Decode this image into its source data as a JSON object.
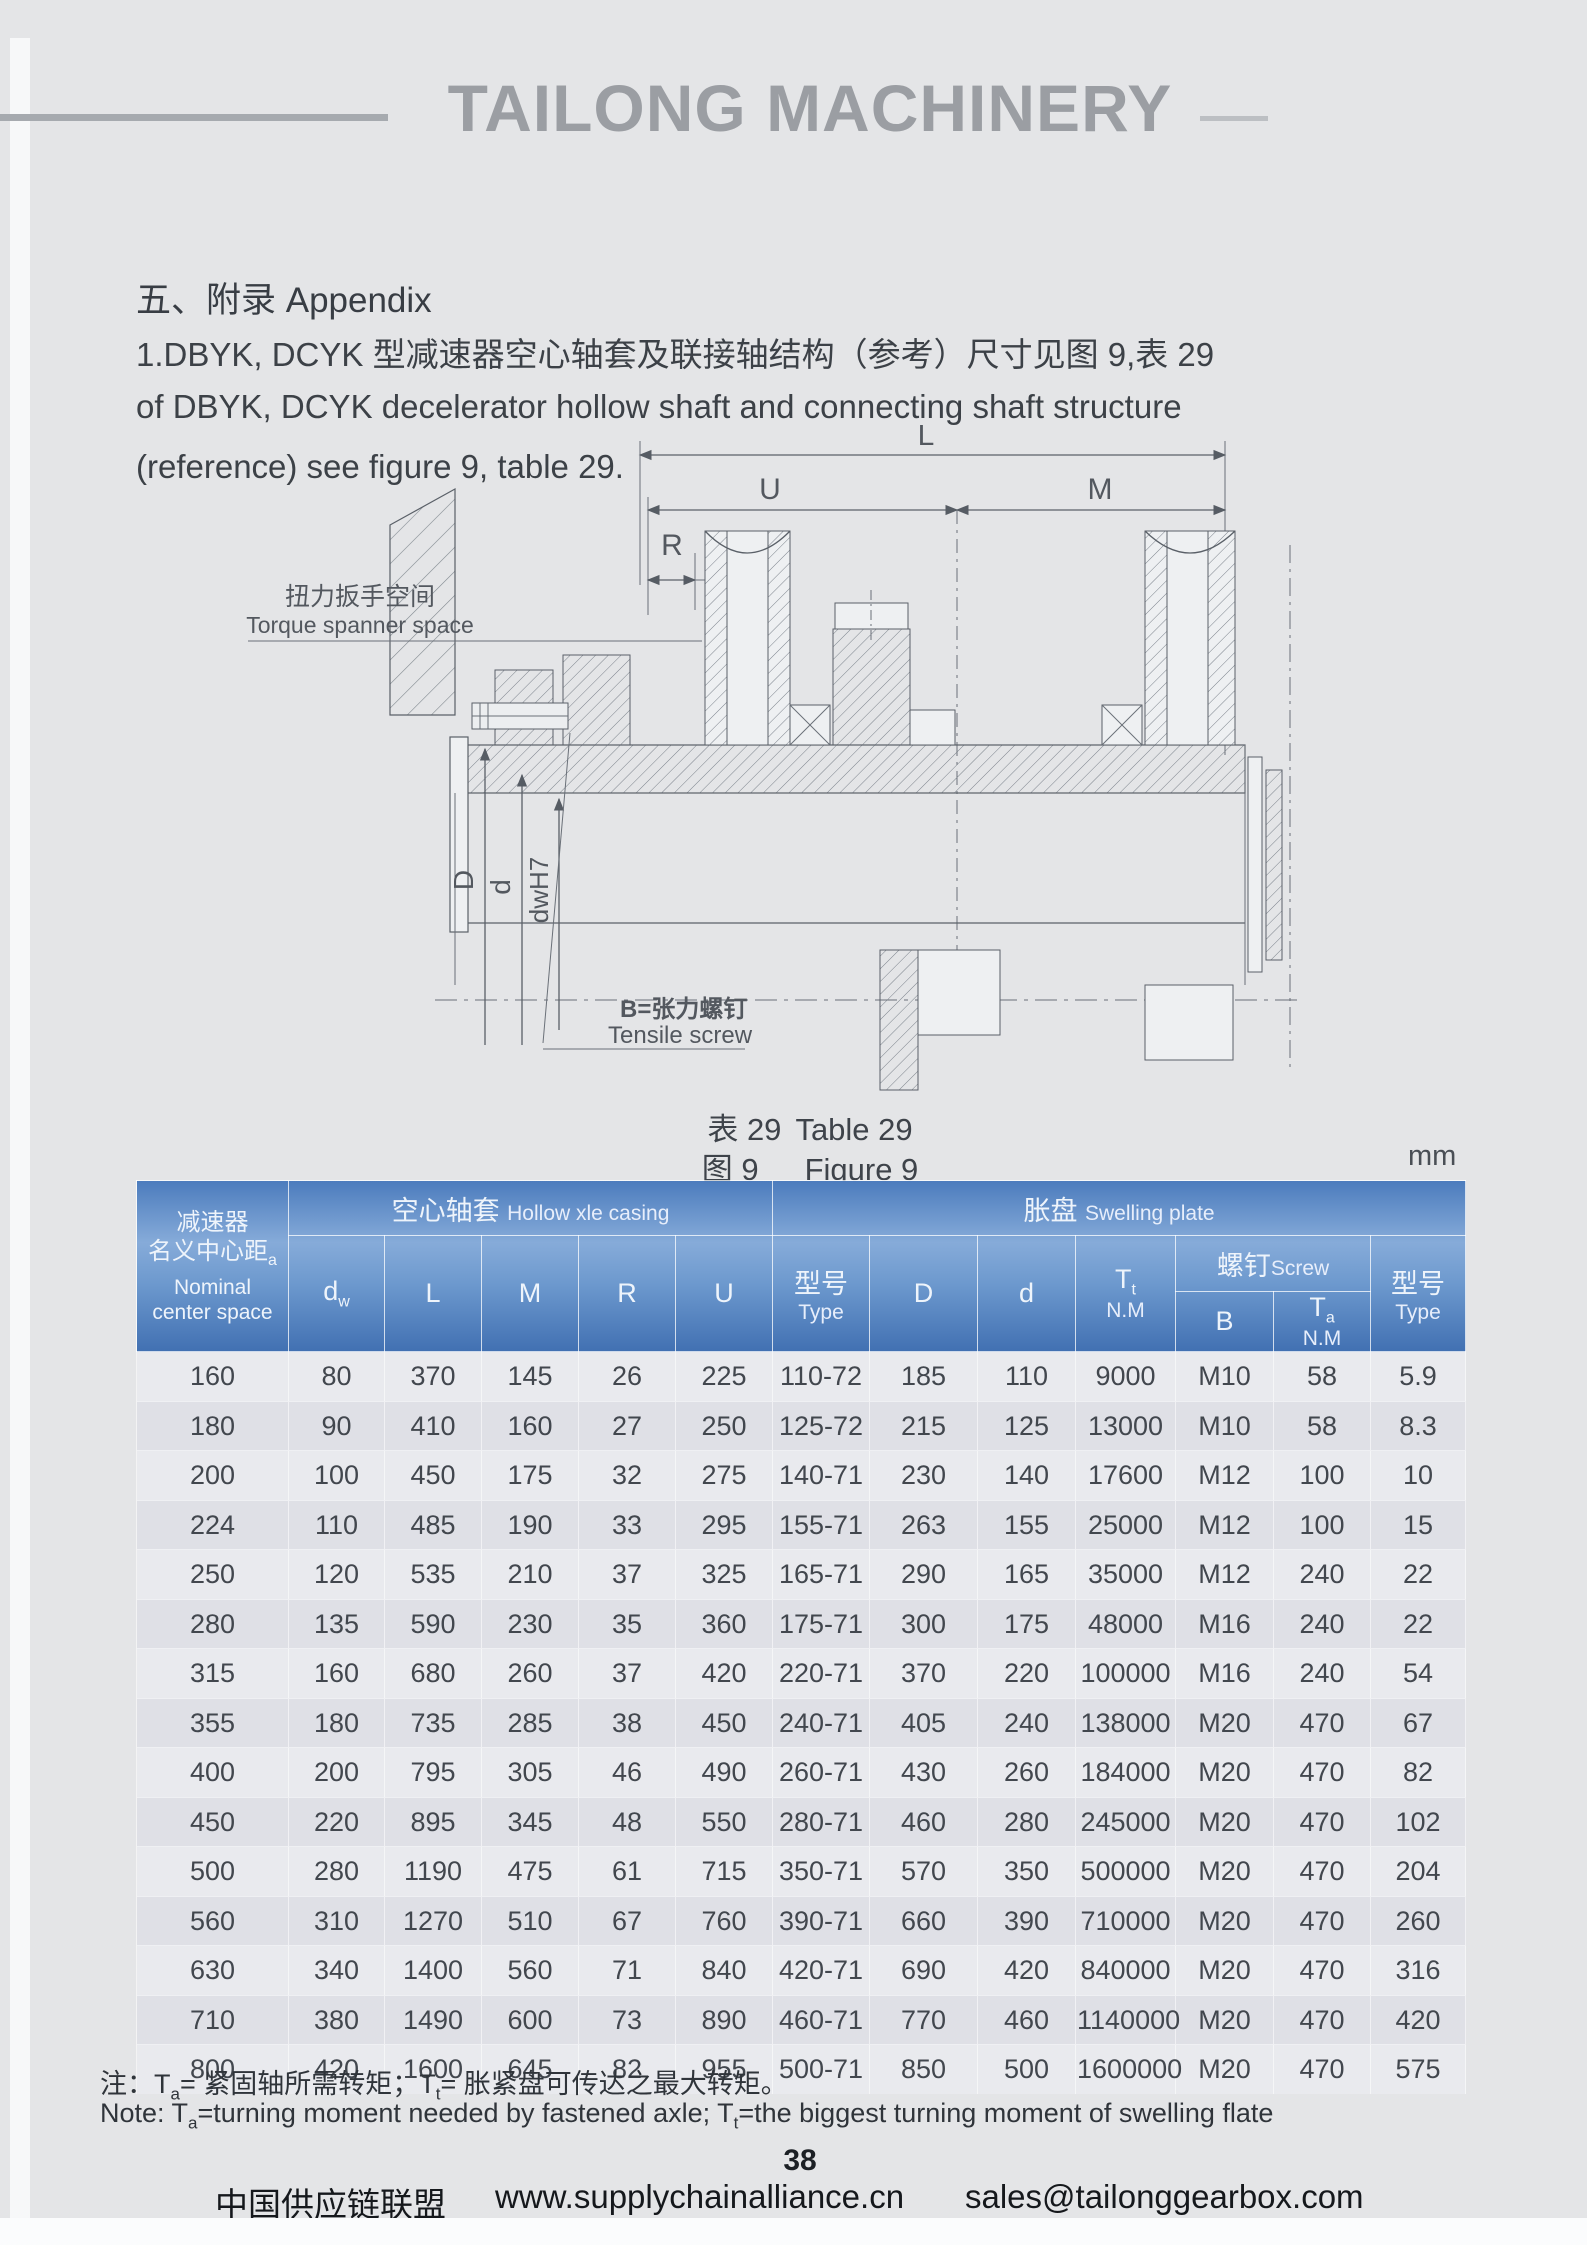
{
  "page": {
    "brand": "TAILONG MACHINERY",
    "page_number": "38",
    "unit_label": "mm"
  },
  "appendix": {
    "title": "五、附录  Appendix",
    "para_line1": "1.DBYK, DCYK 型减速器空心轴套及联接轴结构（参考）尺寸见图 9,表 29",
    "para_line2": "of DBYK, DCYK decelerator hollow shaft and connecting shaft structure",
    "para_line3": "(reference) see figure 9, table 29."
  },
  "figure": {
    "labels": {
      "L": "L",
      "U": "U",
      "M": "M",
      "R": "R",
      "D": "D",
      "d": "d",
      "dwh7": "dwH7",
      "torque_cn": "扭力扳手空间",
      "torque_en": "Torque spanner space",
      "tensile_cn": "B=张力螺钉",
      "tensile_en": "Tensile screw"
    },
    "caption_table_cn": "表 29",
    "caption_table_en": "Table 29",
    "caption_figure_cn": "图 9",
    "caption_figure_en": "Figure 9"
  },
  "table": {
    "col1": {
      "cn1": "减速器",
      "cn2": "名义中心距",
      "cn2_sub": "a",
      "en1": "Nominal",
      "en2": "center space"
    },
    "groups": {
      "hollow_cn": "空心轴套",
      "hollow_en": "Hollow xle casing",
      "swell_cn": "胀盘",
      "swell_en": "Swelling plate",
      "screw_cn": "螺钉",
      "screw_en": "Screw"
    },
    "cols": {
      "dw_main": "d",
      "dw_sub": "w",
      "L": "L",
      "M": "M",
      "R": "R",
      "U": "U",
      "type_cn": "型号",
      "type_en": "Type",
      "D": "D",
      "d": "d",
      "t_main": "T",
      "tt_sub": "t",
      "ta_sub": "a",
      "nm": "N.M",
      "B": "B"
    },
    "rows": [
      [
        "160",
        "80",
        "370",
        "145",
        "26",
        "225",
        "110-72",
        "185",
        "110",
        "9000",
        "M10",
        "58",
        "5.9"
      ],
      [
        "180",
        "90",
        "410",
        "160",
        "27",
        "250",
        "125-72",
        "215",
        "125",
        "13000",
        "M10",
        "58",
        "8.3"
      ],
      [
        "200",
        "100",
        "450",
        "175",
        "32",
        "275",
        "140-71",
        "230",
        "140",
        "17600",
        "M12",
        "100",
        "10"
      ],
      [
        "224",
        "110",
        "485",
        "190",
        "33",
        "295",
        "155-71",
        "263",
        "155",
        "25000",
        "M12",
        "100",
        "15"
      ],
      [
        "250",
        "120",
        "535",
        "210",
        "37",
        "325",
        "165-71",
        "290",
        "165",
        "35000",
        "M12",
        "240",
        "22"
      ],
      [
        "280",
        "135",
        "590",
        "230",
        "35",
        "360",
        "175-71",
        "300",
        "175",
        "48000",
        "M16",
        "240",
        "22"
      ],
      [
        "315",
        "160",
        "680",
        "260",
        "37",
        "420",
        "220-71",
        "370",
        "220",
        "100000",
        "M16",
        "240",
        "54"
      ],
      [
        "355",
        "180",
        "735",
        "285",
        "38",
        "450",
        "240-71",
        "405",
        "240",
        "138000",
        "M20",
        "470",
        "67"
      ],
      [
        "400",
        "200",
        "795",
        "305",
        "46",
        "490",
        "260-71",
        "430",
        "260",
        "184000",
        "M20",
        "470",
        "82"
      ],
      [
        "450",
        "220",
        "895",
        "345",
        "48",
        "550",
        "280-71",
        "460",
        "280",
        "245000",
        "M20",
        "470",
        "102"
      ],
      [
        "500",
        "280",
        "1190",
        "475",
        "61",
        "715",
        "350-71",
        "570",
        "350",
        "500000",
        "M20",
        "470",
        "204"
      ],
      [
        "560",
        "310",
        "1270",
        "510",
        "67",
        "760",
        "390-71",
        "660",
        "390",
        "710000",
        "M20",
        "470",
        "260"
      ],
      [
        "630",
        "340",
        "1400",
        "560",
        "71",
        "840",
        "420-71",
        "690",
        "420",
        "840000",
        "M20",
        "470",
        "316"
      ],
      [
        "710",
        "380",
        "1490",
        "600",
        "73",
        "890",
        "460-71",
        "770",
        "460",
        "1140000",
        "M20",
        "470",
        "420"
      ],
      [
        "800",
        "420",
        "1600",
        "645",
        "82",
        "955",
        "500-71",
        "850",
        "500",
        "1600000",
        "M20",
        "470",
        "575"
      ]
    ]
  },
  "notes": {
    "cn": [
      "注：T",
      "a",
      "= 紧固轴所需转矩；T",
      "t",
      "= 胀紧盘可传达之最大转矩。"
    ],
    "en": [
      "Note: T",
      "a",
      "=turning moment needed by fastened axle; T",
      "t",
      "=the biggest turning moment of swelling flate"
    ]
  },
  "footer": {
    "org": "中国供应链联盟",
    "url": "www.supplychainalliance.cn",
    "email": "sales@tailonggearbox.com"
  },
  "colors": {
    "header_blue_top": "#4c7cbd",
    "header_blue_mid": "#86abd9",
    "header_blue_bottom": "#4170b2",
    "row_odd": "#e9eaee",
    "row_even": "#dfe0e6",
    "brand_gray": "#9b9ea3"
  }
}
